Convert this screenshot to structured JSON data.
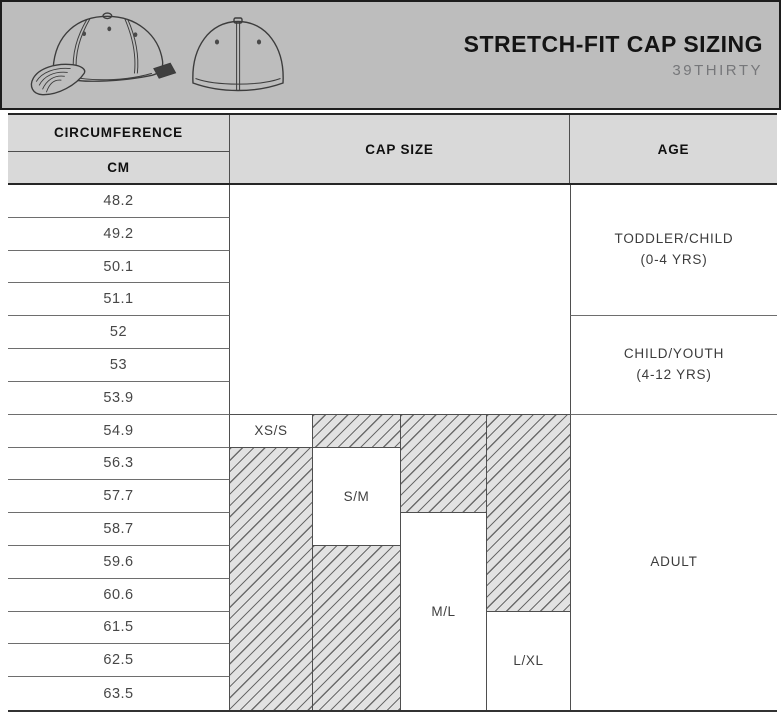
{
  "banner": {
    "title": "STRETCH-FIT CAP SIZING",
    "subtitle": "39THIRTY",
    "icons": [
      {
        "name": "cap-side-view-icon",
        "description": "stretch-fit cap line drawing, side view with curved brim and New Era flag logo"
      },
      {
        "name": "cap-back-view-icon",
        "description": "stretch-fit cap line drawing, back view with center seam"
      }
    ]
  },
  "table": {
    "header": {
      "circumference": "CIRCUMFERENCE",
      "unit": "CM",
      "cap_size": "CAP SIZE",
      "age": "AGE"
    },
    "cm_values": [
      "48.2",
      "49.2",
      "50.1",
      "51.1",
      "52",
      "53",
      "53.9",
      "54.9",
      "56.3",
      "57.7",
      "58.7",
      "59.6",
      "60.6",
      "61.5",
      "62.5",
      "63.5"
    ],
    "sizes": [
      {
        "label": "XS/S",
        "cm_min": "54.9",
        "cm_max": "54.9"
      },
      {
        "label": "S/M",
        "cm_min": "56.3",
        "cm_max": "58.7"
      },
      {
        "label": "M/L",
        "cm_min": "58.7",
        "cm_max": "63.5"
      },
      {
        "label": "L/XL",
        "cm_min": "61.5",
        "cm_max": "63.5"
      }
    ],
    "age_groups": [
      {
        "label": "TODDLER/CHILD",
        "range": "(0-4 YRS)",
        "cm_min": "48.2",
        "cm_max": "51.1"
      },
      {
        "label": "CHILD/YOUTH",
        "range": "(4-12 YRS)",
        "cm_min": "52",
        "cm_max": "53.9"
      },
      {
        "label": "ADULT",
        "range": "",
        "cm_min": "54.9",
        "cm_max": "63.5"
      }
    ]
  },
  "colors": {
    "banner_bg": "#bdbdbd",
    "header_bg": "#d9d9d9",
    "hatch_bg": "#e2e2e2",
    "hatch_line": "#6b6b6b",
    "grid_line_dark": "#4f4f4f",
    "grid_line_light": "#6e6e6e",
    "text_dark": "#141414",
    "text_mid": "#474747",
    "subtitle_gray": "#76777a"
  }
}
